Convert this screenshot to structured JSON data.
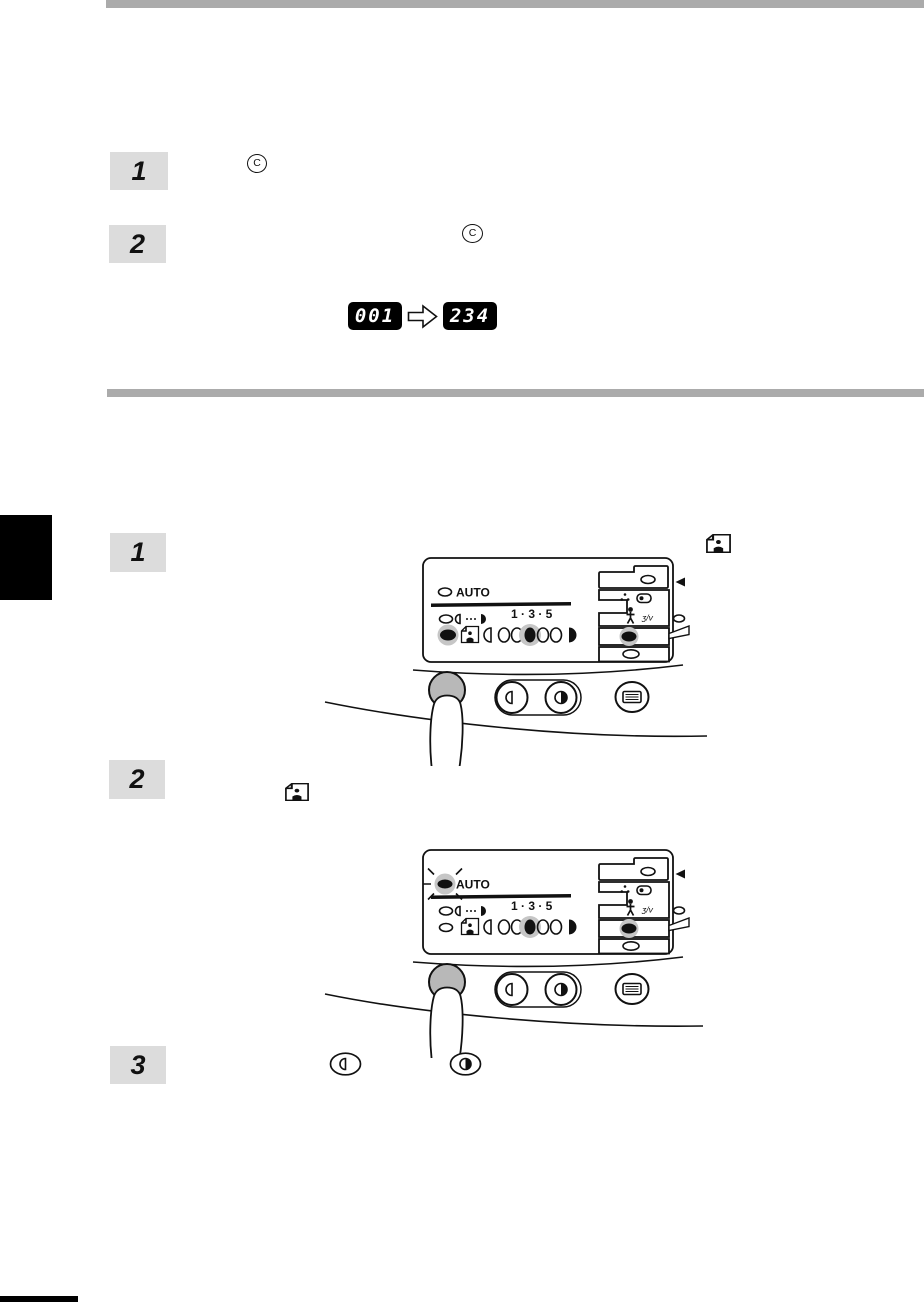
{
  "page": {
    "background": "#ffffff",
    "accent_bar_color": "#ababab",
    "step_box_color": "#dcdcdc"
  },
  "upper_section": {
    "steps": [
      {
        "number": "1"
      },
      {
        "number": "2"
      }
    ],
    "clear_key_label": "C",
    "copy_counter": {
      "before": "001",
      "after": "234"
    }
  },
  "lower_section": {
    "steps": [
      {
        "number": "1"
      },
      {
        "number": "2"
      },
      {
        "number": "3"
      }
    ]
  },
  "control_panel": {
    "auto_label": "AUTO",
    "exposure_scale_label": "1 · 3 · 5",
    "mode_symbol": "ʒ/v"
  },
  "colors": {
    "highlight_gray": "#c6c6c6",
    "pressed_button_gray": "#b8b8b8",
    "lcd_background": "#000000",
    "lcd_digits": "#ffffff"
  }
}
